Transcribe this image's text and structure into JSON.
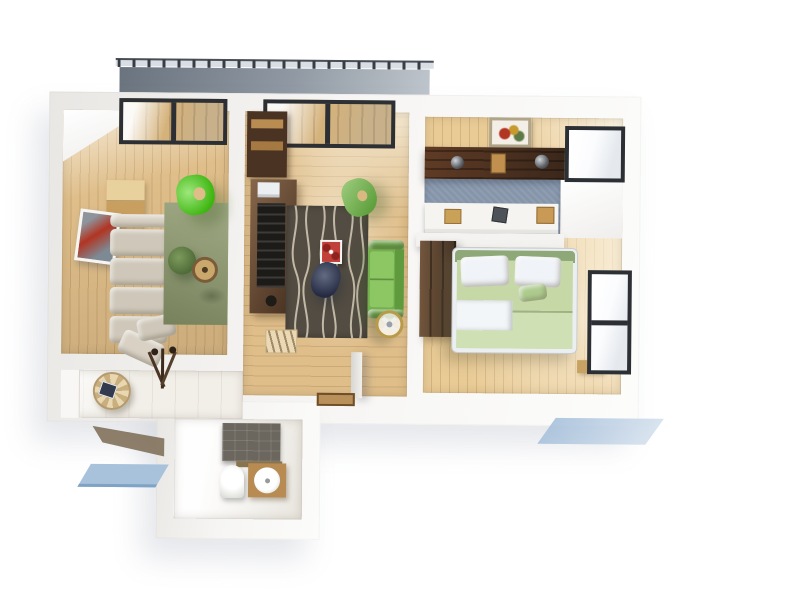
{
  "scene": {
    "title": "3D top-view render of a two-room apartment floor plan",
    "type": "architectural 3d floor plan",
    "background": "#ffffff"
  },
  "palette": {
    "wall": "#f4f3f1",
    "balcony_floor": "#9099a3",
    "balcony_rail": "#d8dee4",
    "wood_floor": "#dfbe8a",
    "wood_floor_bedroom": "#e9cb96",
    "tile_floor": "#f2efe9",
    "window_frame": "#2c2f33",
    "glass": "#fafbfd",
    "window_wood": "#cda463",
    "rug_olive": "#8d986f",
    "rug_dark": "#524c42",
    "rug_wave_lines": "#cfc5b2",
    "sofa_beige": "#cfc8ba",
    "cushion_beige": "#d8d1c4",
    "chair_bright_green": "#4fd312",
    "chair_green": "#6db43e",
    "sofa_green": "#74b14c",
    "sofa_green_seat": "#8cc763",
    "sofa_green_arm": "#5f9a3e",
    "bed_frame": "#eceff1",
    "bed_green": "#c6d8a6",
    "bed_green_light": "#cfe0b4",
    "bed_headboard": "#8fa878",
    "pillow_white": "#f0f3f7",
    "sideboard_wood": "#5d3f29",
    "cabinet_dark": "#4a3322",
    "beam_wood": "#4e3423",
    "wardrobe_wood": "#55402f",
    "carpet_blue": "#8695aa",
    "desk_white": "#f5f4f1",
    "tv_screen": "#1d1b18",
    "printer_white": "#eceff1",
    "art_red": "#b23422",
    "art_gray": "#8d949c",
    "table_wood": "#caa76b",
    "table_rim": "#7a5b3a",
    "plant_green": "#5d7a46",
    "shower_tile": "#6b675e",
    "counter_wood": "#b78b52",
    "porcelain": "#ffffff",
    "doormat": "#b98f5a",
    "shadow_blue": "#a9c2dc",
    "ground_brown": "#7b6a52",
    "fan_gold": "#b99a4a",
    "navy_chair": "#3b4661",
    "cabinet_light": "#e9d19e",
    "cabinet_mid": "#c99f60",
    "red_cloth": "#c2403a"
  },
  "balcony": {
    "name": "Balcony",
    "railing": "dark metal posts on light rail",
    "floor": "concrete gray"
  },
  "rooms": [
    {
      "name": "Living room",
      "floor": "light oak planks",
      "rug": "olive green rug",
      "furniture": [
        "beige corner sofa with cushions",
        "bright green swivel chair",
        "round wooden coffee table",
        "potted plant",
        "red abstract wall art",
        "light wood cabinet",
        "balcony window"
      ]
    },
    {
      "name": "Lounge",
      "floor": "light oak planks",
      "rug": "dark gray rug with wavy cream lines",
      "furniture": [
        "dark walnut TV sideboard",
        "flat TV",
        "white printer",
        "green two-seat sofa",
        "green lounge chair",
        "white side table with red poinsettia cloth",
        "navy chair",
        "pedestal fan",
        "magazine bench",
        "balcony door",
        "open entry door",
        "doormat"
      ]
    },
    {
      "name": "Bedroom with study nook",
      "floor": "light oak planks",
      "furniture": [
        "double bed with green bedding",
        "two white pillows",
        "white throw blanket",
        "dark wardrobe",
        "white study desk with frames and books",
        "blue carpet",
        "dark wood shelf beam with spotlights",
        "framed picture",
        "corner window",
        "side window",
        "foot bench"
      ]
    },
    {
      "name": "Hallway",
      "floor": "white tile",
      "furniture": [
        "round striped side table",
        "dark tablet",
        "coat rack"
      ]
    },
    {
      "name": "Bathroom",
      "floor": "white tile",
      "furniture": [
        "dark gray shower tile wall",
        "toilet",
        "washing machine under wooden counter"
      ]
    }
  ]
}
